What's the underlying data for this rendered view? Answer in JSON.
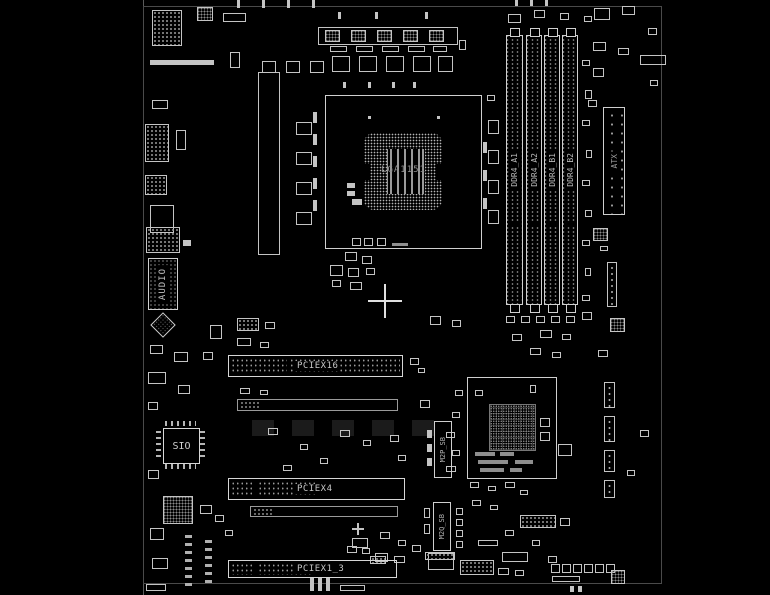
{
  "diagram": {
    "type": "motherboard-boardview",
    "background_color": "#000000",
    "line_color": "#c4c4c4",
    "text_color": "#b8b8b8"
  },
  "labels": {
    "cpu_socket": "LGA1151",
    "atx_power": "ATX",
    "audio": "AUDIO",
    "super_io": "SIO",
    "pciex16": "PCIEX16",
    "pciex4": "PCIEX4",
    "pciex1_3": "PCIEX1_3",
    "m2_top": "M2P_SB",
    "m2_bottom": "M2Q_SB"
  },
  "ddr": {
    "labels": [
      "DDR4_A1",
      "DDR4_A2",
      "DDR4_B1",
      "DDR4_B2"
    ],
    "x": [
      506,
      526,
      544,
      562
    ],
    "w": [
      17,
      16,
      16,
      16
    ],
    "y": 35,
    "h": 270
  },
  "parts": [
    [
      152,
      10,
      30,
      36,
      "dots"
    ],
    [
      197,
      7,
      16,
      14,
      "chipx"
    ],
    [
      223,
      13,
      23,
      9,
      "rect"
    ],
    [
      150,
      60,
      64,
      5,
      "solid"
    ],
    [
      230,
      52,
      10,
      16,
      "rect"
    ],
    [
      152,
      100,
      16,
      9,
      "rect"
    ],
    [
      145,
      124,
      24,
      38,
      "dots"
    ],
    [
      176,
      130,
      10,
      20,
      "rect"
    ],
    [
      145,
      175,
      22,
      20,
      "dots"
    ],
    [
      150,
      205,
      24,
      28,
      "rect"
    ],
    [
      146,
      227,
      34,
      26,
      "dots"
    ],
    [
      183,
      240,
      8,
      6,
      "solid"
    ],
    [
      150,
      345,
      13,
      9,
      "rect"
    ],
    [
      174,
      352,
      14,
      10,
      "rect"
    ],
    [
      148,
      372,
      18,
      12,
      "rect"
    ],
    [
      178,
      385,
      12,
      9,
      "rect"
    ],
    [
      203,
      352,
      10,
      8,
      "rect"
    ],
    [
      210,
      325,
      12,
      14,
      "rect"
    ],
    [
      148,
      402,
      10,
      8,
      "rect"
    ],
    [
      148,
      470,
      11,
      9,
      "rect"
    ],
    [
      163,
      496,
      30,
      28,
      "chipx"
    ],
    [
      150,
      528,
      14,
      12,
      "rect"
    ],
    [
      152,
      558,
      16,
      11,
      "rect"
    ],
    [
      146,
      584,
      20,
      7,
      "rect"
    ],
    [
      185,
      535,
      7,
      52,
      "dashcol"
    ],
    [
      205,
      540,
      7,
      47,
      "dashcol"
    ],
    [
      200,
      505,
      12,
      9,
      "rect"
    ],
    [
      215,
      515,
      9,
      7,
      "rect"
    ],
    [
      225,
      530,
      8,
      6,
      "rect"
    ],
    [
      318,
      27,
      140,
      18,
      "rect"
    ],
    [
      325,
      30,
      15,
      12,
      "chipx"
    ],
    [
      351,
      30,
      15,
      12,
      "chipx"
    ],
    [
      377,
      30,
      15,
      12,
      "chipx"
    ],
    [
      403,
      30,
      15,
      12,
      "chipx"
    ],
    [
      429,
      30,
      15,
      12,
      "chipx"
    ],
    [
      330,
      46,
      17,
      6,
      "rect"
    ],
    [
      356,
      46,
      17,
      6,
      "rect"
    ],
    [
      382,
      46,
      17,
      6,
      "rect"
    ],
    [
      408,
      46,
      17,
      6,
      "rect"
    ],
    [
      433,
      46,
      14,
      6,
      "rect"
    ],
    [
      332,
      56,
      18,
      16,
      "rect"
    ],
    [
      359,
      56,
      18,
      16,
      "rect"
    ],
    [
      386,
      56,
      18,
      16,
      "rect"
    ],
    [
      413,
      56,
      18,
      16,
      "rect"
    ],
    [
      438,
      56,
      15,
      16,
      "rect"
    ],
    [
      459,
      40,
      7,
      10,
      "rect"
    ],
    [
      237,
      0,
      3,
      8,
      "solid"
    ],
    [
      262,
      0,
      3,
      8,
      "solid"
    ],
    [
      287,
      0,
      3,
      8,
      "solid"
    ],
    [
      312,
      0,
      3,
      8,
      "solid"
    ],
    [
      338,
      12,
      3,
      7,
      "solid"
    ],
    [
      375,
      12,
      3,
      7,
      "solid"
    ],
    [
      425,
      12,
      3,
      7,
      "solid"
    ],
    [
      262,
      61,
      14,
      12,
      "rect"
    ],
    [
      286,
      61,
      14,
      12,
      "rect"
    ],
    [
      310,
      61,
      14,
      12,
      "rect"
    ],
    [
      258,
      72,
      22,
      183,
      "rect"
    ],
    [
      296,
      122,
      16,
      13,
      "rect"
    ],
    [
      296,
      152,
      16,
      13,
      "rect"
    ],
    [
      296,
      182,
      16,
      13,
      "rect"
    ],
    [
      296,
      212,
      16,
      13,
      "rect"
    ],
    [
      313,
      112,
      4,
      11,
      "solid"
    ],
    [
      313,
      134,
      4,
      11,
      "solid"
    ],
    [
      313,
      156,
      4,
      11,
      "solid"
    ],
    [
      313,
      178,
      4,
      11,
      "solid"
    ],
    [
      313,
      200,
      4,
      11,
      "solid"
    ],
    [
      343,
      82,
      3,
      6,
      "solid"
    ],
    [
      368,
      82,
      3,
      6,
      "solid"
    ],
    [
      392,
      82,
      3,
      6,
      "solid"
    ],
    [
      413,
      82,
      3,
      6,
      "solid"
    ],
    [
      483,
      142,
      4,
      11,
      "solid"
    ],
    [
      483,
      170,
      4,
      11,
      "solid"
    ],
    [
      483,
      198,
      4,
      11,
      "solid"
    ],
    [
      487,
      95,
      8,
      6,
      "rect"
    ],
    [
      488,
      120,
      11,
      14,
      "rect"
    ],
    [
      488,
      150,
      11,
      14,
      "rect"
    ],
    [
      488,
      180,
      11,
      14,
      "rect"
    ],
    [
      488,
      210,
      11,
      14,
      "rect"
    ],
    [
      347,
      183,
      8,
      5,
      "solid"
    ],
    [
      347,
      191,
      8,
      5,
      "solid"
    ],
    [
      352,
      199,
      10,
      6,
      "solid"
    ],
    [
      352,
      238,
      9,
      8,
      "rect"
    ],
    [
      364,
      238,
      9,
      8,
      "rect"
    ],
    [
      377,
      238,
      9,
      8,
      "rect"
    ],
    [
      392,
      243,
      16,
      3,
      "hbar"
    ],
    [
      368,
      116,
      3,
      3,
      "solid"
    ],
    [
      437,
      116,
      3,
      3,
      "solid"
    ],
    [
      345,
      252,
      12,
      9,
      "rect"
    ],
    [
      362,
      256,
      10,
      8,
      "rect"
    ],
    [
      330,
      265,
      13,
      11,
      "rect"
    ],
    [
      348,
      268,
      11,
      9,
      "rect"
    ],
    [
      366,
      268,
      9,
      7,
      "rect"
    ],
    [
      332,
      280,
      9,
      7,
      "rect"
    ],
    [
      350,
      282,
      12,
      8,
      "rect"
    ],
    [
      430,
      316,
      11,
      9,
      "rect"
    ],
    [
      452,
      320,
      9,
      7,
      "rect"
    ],
    [
      237,
      318,
      22,
      13,
      "dots"
    ],
    [
      265,
      322,
      10,
      7,
      "rect"
    ],
    [
      237,
      338,
      14,
      8,
      "rect"
    ],
    [
      260,
      342,
      9,
      6,
      "rect"
    ],
    [
      410,
      358,
      9,
      7,
      "rect"
    ],
    [
      418,
      368,
      7,
      5,
      "rect"
    ],
    [
      240,
      388,
      10,
      6,
      "rect"
    ],
    [
      260,
      390,
      8,
      5,
      "rect"
    ],
    [
      252,
      420,
      22,
      16,
      "dim"
    ],
    [
      292,
      420,
      22,
      16,
      "dim"
    ],
    [
      332,
      420,
      22,
      16,
      "dim"
    ],
    [
      372,
      420,
      22,
      16,
      "dim"
    ],
    [
      412,
      420,
      22,
      16,
      "dim"
    ],
    [
      340,
      430,
      10,
      7,
      "rect"
    ],
    [
      363,
      440,
      8,
      6,
      "rect"
    ],
    [
      390,
      435,
      9,
      7,
      "rect"
    ],
    [
      300,
      444,
      8,
      6,
      "rect"
    ],
    [
      268,
      428,
      10,
      7,
      "rect"
    ],
    [
      320,
      458,
      8,
      6,
      "rect"
    ],
    [
      283,
      465,
      9,
      6,
      "rect"
    ],
    [
      398,
      455,
      8,
      6,
      "rect"
    ],
    [
      420,
      400,
      10,
      8,
      "rect"
    ],
    [
      455,
      390,
      8,
      6,
      "rect"
    ],
    [
      452,
      412,
      8,
      6,
      "rect"
    ],
    [
      446,
      432,
      9,
      6,
      "rect"
    ],
    [
      452,
      450,
      8,
      6,
      "rect"
    ],
    [
      446,
      466,
      10,
      6,
      "rect"
    ],
    [
      427,
      430,
      5,
      8,
      "solid"
    ],
    [
      427,
      444,
      5,
      8,
      "solid"
    ],
    [
      427,
      458,
      5,
      8,
      "solid"
    ],
    [
      424,
      508,
      6,
      10,
      "rect"
    ],
    [
      424,
      524,
      6,
      10,
      "rect"
    ],
    [
      456,
      508,
      7,
      7,
      "rect"
    ],
    [
      456,
      519,
      7,
      7,
      "rect"
    ],
    [
      456,
      530,
      7,
      7,
      "rect"
    ],
    [
      456,
      541,
      7,
      7,
      "rect"
    ],
    [
      594,
      8,
      16,
      12,
      "rect"
    ],
    [
      622,
      6,
      13,
      9,
      "rect"
    ],
    [
      648,
      28,
      9,
      7,
      "rect"
    ],
    [
      593,
      42,
      13,
      9,
      "rect"
    ],
    [
      618,
      48,
      11,
      7,
      "rect"
    ],
    [
      593,
      68,
      11,
      9,
      "rect"
    ],
    [
      640,
      55,
      26,
      10,
      "rect"
    ],
    [
      650,
      80,
      8,
      6,
      "rect"
    ],
    [
      588,
      100,
      9,
      7,
      "rect"
    ],
    [
      593,
      228,
      15,
      13,
      "chipx"
    ],
    [
      600,
      246,
      8,
      5,
      "rect"
    ],
    [
      607,
      262,
      10,
      45,
      "vdots"
    ],
    [
      610,
      318,
      15,
      14,
      "chipx"
    ],
    [
      598,
      350,
      10,
      7,
      "rect"
    ],
    [
      604,
      382,
      11,
      26,
      "vdots"
    ],
    [
      604,
      416,
      11,
      26,
      "vdots"
    ],
    [
      604,
      450,
      11,
      22,
      "vdots"
    ],
    [
      604,
      480,
      11,
      18,
      "vdots"
    ],
    [
      640,
      430,
      9,
      7,
      "rect"
    ],
    [
      558,
      444,
      14,
      12,
      "rect"
    ],
    [
      627,
      470,
      8,
      6,
      "rect"
    ],
    [
      508,
      14,
      13,
      9,
      "rect"
    ],
    [
      534,
      10,
      11,
      8,
      "rect"
    ],
    [
      560,
      13,
      9,
      7,
      "rect"
    ],
    [
      584,
      16,
      8,
      6,
      "rect"
    ],
    [
      515,
      0,
      3,
      6,
      "solid"
    ],
    [
      530,
      0,
      3,
      6,
      "solid"
    ],
    [
      545,
      0,
      3,
      6,
      "solid"
    ],
    [
      582,
      60,
      8,
      6,
      "rect"
    ],
    [
      585,
      90,
      7,
      9,
      "rect"
    ],
    [
      582,
      120,
      8,
      6,
      "rect"
    ],
    [
      586,
      150,
      6,
      8,
      "rect"
    ],
    [
      582,
      180,
      8,
      6,
      "rect"
    ],
    [
      585,
      210,
      7,
      7,
      "rect"
    ],
    [
      582,
      240,
      8,
      6,
      "rect"
    ],
    [
      585,
      268,
      6,
      8,
      "rect"
    ],
    [
      582,
      295,
      8,
      6,
      "rect"
    ],
    [
      506,
      316,
      9,
      7,
      "rect"
    ],
    [
      521,
      316,
      9,
      7,
      "rect"
    ],
    [
      536,
      316,
      9,
      7,
      "rect"
    ],
    [
      551,
      316,
      9,
      7,
      "rect"
    ],
    [
      566,
      316,
      9,
      7,
      "rect"
    ],
    [
      582,
      312,
      10,
      8,
      "rect"
    ],
    [
      540,
      330,
      12,
      8,
      "rect"
    ],
    [
      562,
      334,
      9,
      6,
      "rect"
    ],
    [
      512,
      334,
      10,
      7,
      "rect"
    ],
    [
      530,
      348,
      11,
      7,
      "rect"
    ],
    [
      552,
      352,
      9,
      6,
      "rect"
    ],
    [
      475,
      390,
      8,
      6,
      "rect"
    ],
    [
      530,
      385,
      6,
      8,
      "rect"
    ],
    [
      540,
      418,
      10,
      9,
      "rect"
    ],
    [
      540,
      432,
      10,
      9,
      "rect"
    ],
    [
      475,
      452,
      20,
      4,
      "hbar"
    ],
    [
      500,
      452,
      14,
      4,
      "hbar"
    ],
    [
      478,
      460,
      30,
      4,
      "hbar"
    ],
    [
      515,
      460,
      18,
      4,
      "hbar"
    ],
    [
      480,
      468,
      24,
      4,
      "hbar"
    ],
    [
      510,
      468,
      12,
      4,
      "hbar"
    ],
    [
      470,
      482,
      9,
      6,
      "rect"
    ],
    [
      488,
      486,
      8,
      5,
      "rect"
    ],
    [
      505,
      482,
      10,
      6,
      "rect"
    ],
    [
      520,
      490,
      8,
      5,
      "rect"
    ],
    [
      472,
      500,
      9,
      6,
      "rect"
    ],
    [
      490,
      505,
      8,
      5,
      "rect"
    ],
    [
      520,
      515,
      36,
      13,
      "dots"
    ],
    [
      560,
      518,
      10,
      8,
      "rect"
    ],
    [
      505,
      530,
      9,
      6,
      "rect"
    ],
    [
      478,
      540,
      20,
      6,
      "rect"
    ],
    [
      532,
      540,
      8,
      6,
      "rect"
    ],
    [
      502,
      552,
      26,
      10,
      "rect"
    ],
    [
      548,
      556,
      9,
      7,
      "rect"
    ],
    [
      551,
      564,
      9,
      9,
      "rect"
    ],
    [
      562,
      564,
      9,
      9,
      "rect"
    ],
    [
      573,
      564,
      9,
      9,
      "rect"
    ],
    [
      584,
      564,
      9,
      9,
      "rect"
    ],
    [
      595,
      564,
      9,
      9,
      "rect"
    ],
    [
      606,
      564,
      9,
      9,
      "rect"
    ],
    [
      552,
      576,
      28,
      6,
      "rect"
    ],
    [
      611,
      570,
      14,
      14,
      "chipx"
    ],
    [
      570,
      586,
      4,
      6,
      "solid"
    ],
    [
      578,
      586,
      4,
      6,
      "solid"
    ],
    [
      310,
      578,
      4,
      13,
      "solid"
    ],
    [
      318,
      578,
      4,
      13,
      "solid"
    ],
    [
      326,
      578,
      4,
      13,
      "solid"
    ],
    [
      340,
      585,
      25,
      6,
      "rect"
    ],
    [
      375,
      553,
      13,
      9,
      "rect"
    ],
    [
      394,
      556,
      11,
      7,
      "rect"
    ],
    [
      412,
      545,
      9,
      7,
      "rect"
    ],
    [
      428,
      553,
      26,
      17,
      "rect"
    ],
    [
      460,
      560,
      34,
      15,
      "dots"
    ],
    [
      498,
      568,
      11,
      7,
      "rect"
    ],
    [
      515,
      570,
      9,
      6,
      "rect"
    ],
    [
      352,
      538,
      16,
      10,
      "rect"
    ],
    [
      380,
      532,
      10,
      7,
      "rect"
    ],
    [
      398,
      540,
      8,
      6,
      "rect"
    ],
    [
      347,
      546,
      10,
      7,
      "rect"
    ],
    [
      362,
      548,
      8,
      6,
      "rect"
    ],
    [
      370,
      556,
      16,
      8,
      "dots"
    ],
    [
      352,
      528,
      12,
      2,
      "solid"
    ],
    [
      357,
      523,
      2,
      12,
      "solid"
    ],
    [
      425,
      552,
      30,
      8,
      "dots"
    ]
  ]
}
